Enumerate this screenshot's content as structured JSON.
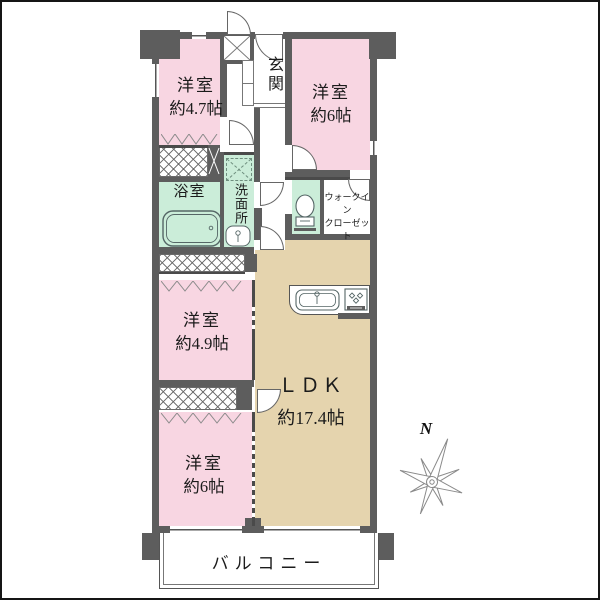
{
  "plan": {
    "type": "apartment-floor-plan",
    "colors": {
      "wall": "#5d5d5d",
      "bedroom_pink": "#f8d6e2",
      "wet_area_mint": "#cbedd9",
      "ldk_beige": "#e5d4ae",
      "line": "#555555"
    },
    "rooms": {
      "bedroom_top_left": {
        "name": "洋室",
        "size": "約4.7帖"
      },
      "bedroom_top_right": {
        "name": "洋室",
        "size": "約6帖"
      },
      "entrance": {
        "label": "玄関"
      },
      "bathroom": {
        "label": "浴室"
      },
      "washroom": {
        "label": "洗面所"
      },
      "walk_in_closet": {
        "line1": "ウォークイン",
        "line2": "クローゼット"
      },
      "bedroom_mid_left": {
        "name": "洋室",
        "size": "約4.9帖"
      },
      "ldk": {
        "name": "ＬＤＫ",
        "size": "約17.4帖"
      },
      "bedroom_bottom_left": {
        "name": "洋室",
        "size": "約6帖"
      },
      "balcony": {
        "label": "バルコニー"
      }
    },
    "compass": {
      "north_label": "N"
    },
    "icons": {
      "bathtub": "bathtub",
      "washbasin": "washbasin",
      "toilet": "toilet",
      "kitchen_sink": "kitchen sink",
      "stove": "gas stove",
      "washer_space": "washing machine space (dashed)",
      "pipe_shaft": "pipe shaft (X box)"
    }
  }
}
